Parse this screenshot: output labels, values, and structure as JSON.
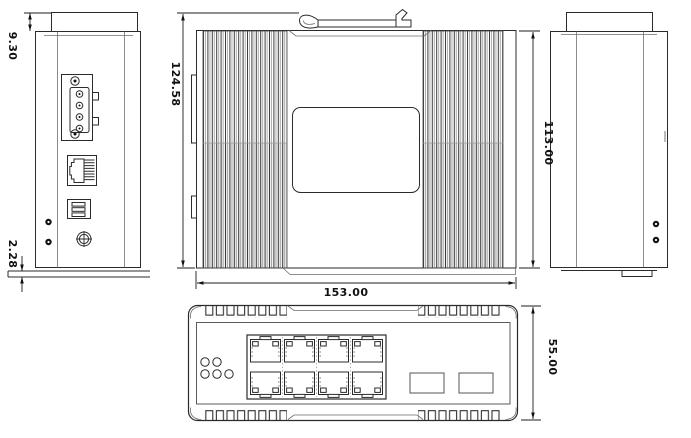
{
  "drawing": {
    "type": "mechanical-dimension-drawing",
    "subject": "industrial-din-rail-ethernet-switch",
    "background_color": "#ffffff",
    "line_color": "#2b2b2b",
    "dimension_text_color": "#111111",
    "dimensions": {
      "flange_offset": "9.30",
      "rail_plate_thickness": "2.28",
      "overall_height_with_clip": "124.58",
      "overall_width": "153.00",
      "body_height": "113.00",
      "body_depth": "55.00"
    },
    "views": {
      "left_side": {
        "label": "left-side-view",
        "components": [
          "power-terminal-block",
          "console-rj45-port",
          "dip-switch",
          "panel-screws",
          "ground-screw"
        ]
      },
      "rear": {
        "label": "rear-view",
        "components": [
          "din-rail-clip",
          "cooling-fins",
          "mounting-plate"
        ]
      },
      "right_side": {
        "label": "right-side-view",
        "components": [
          "panel-screws"
        ]
      },
      "front": {
        "label": "front-panel-view",
        "led_count": 5,
        "rj45_port_count": 8,
        "sfp_slot_count": 2
      }
    }
  }
}
